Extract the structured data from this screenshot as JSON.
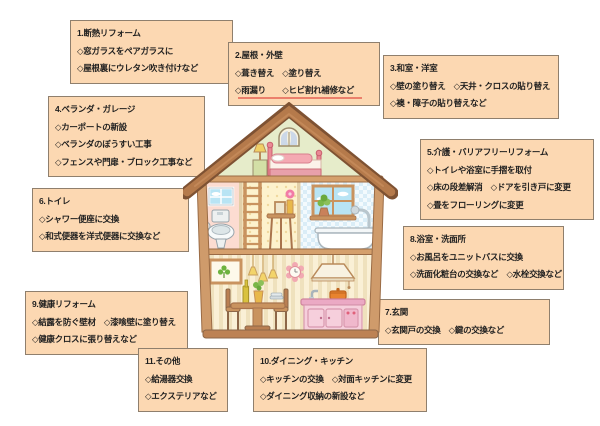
{
  "page": {
    "background": "#ffffff"
  },
  "style": {
    "box_fill": "#fcd8b2",
    "box_border": "#8f7f6d",
    "text_color": "#1f1f1f",
    "roof_brown": "#b57a4b",
    "frame_tan": "#cf9b6b",
    "kitchen_pink": "#f6cfdc",
    "accent_red_line": "#e8705e"
  },
  "diagram_type": "home-renovation-category-map",
  "boxes": [
    {
      "id": "1",
      "title": "1.断熱リフォーム",
      "items": [
        "◇窓ガラスをペアガラスに",
        "◇屋根裏にウレタン吹き付けなど"
      ]
    },
    {
      "id": "2",
      "title": "2.屋根・外壁",
      "items": [
        "◇葺き替え　◇塗り替え",
        "◇雨漏り　　◇ヒビ割れ補修など"
      ]
    },
    {
      "id": "3",
      "title": "3.和室・洋室",
      "items": [
        "◇壁の塗り替え　◇天井・クロスの貼り替え",
        "◇襖・障子の貼り替えなど"
      ]
    },
    {
      "id": "4",
      "title": "4.ベランダ・ガレージ",
      "items": [
        "◇カーポートの新設",
        "◇ベランダのぼうすい工事",
        "◇フェンスや門扉・ブロック工事など"
      ]
    },
    {
      "id": "5",
      "title": "5.介護・バリアフリーリフォーム",
      "items": [
        "◇トイレや浴室に手摺を取付",
        "◇床の段差解消　◇ドアを引き戸に変更",
        "◇畳をフローリングに変更"
      ]
    },
    {
      "id": "6",
      "title": "6.トイレ",
      "items": [
        "◇シャワー便座に交換",
        "◇和式便器を洋式便器に交換など"
      ]
    },
    {
      "id": "7",
      "title": "7.玄関",
      "items": [
        "◇玄関戸の交換　◇鍵の交換など"
      ]
    },
    {
      "id": "8",
      "title": "8.浴室・洗面所",
      "items": [
        "◇お風呂をユニットバスに交換",
        "◇洗面化粧台の交換など　◇水栓交換など"
      ]
    },
    {
      "id": "9",
      "title": "9.健康リフォーム",
      "items": [
        "◇結露を防ぐ壁材　◇漆喰壁に塗り替え",
        "◇健康クロスに張り替えなど"
      ]
    },
    {
      "id": "10",
      "title": "10.ダイニング・キッチン",
      "items": [
        "◇キッチンの交換　◇対面キッチンに変更",
        "◇ダイニング収納の新設など"
      ]
    },
    {
      "id": "11",
      "title": "11.その他",
      "items": [
        "◇給湯器交換",
        "◇エクステリアなど"
      ]
    }
  ],
  "house": {
    "name": "cutaway-house-illustration",
    "rooms": [
      "attic-bedroom",
      "toilet-room",
      "stair-hall",
      "bathroom",
      "dining-kitchen"
    ]
  }
}
